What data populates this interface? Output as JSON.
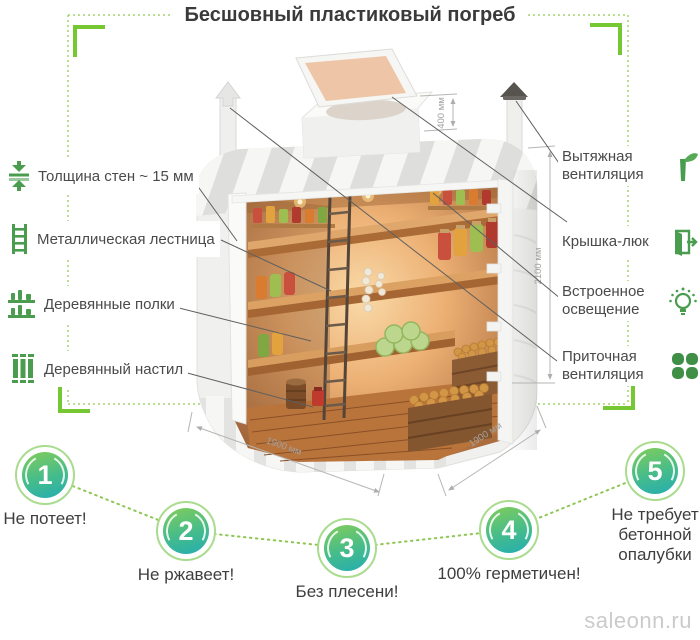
{
  "title": "Бесшовный пластиковый погреб",
  "left_labels": [
    {
      "label": "Толщина стен ~ 15 мм",
      "icon": "wall-thickness-icon"
    },
    {
      "label": "Металлическая лестница",
      "icon": "ladder-icon"
    },
    {
      "label": "Деревянные полки",
      "icon": "shelves-icon"
    },
    {
      "label": "Деревянный настил",
      "icon": "decking-icon"
    }
  ],
  "right_labels": [
    {
      "label": "Вытяжная вентиляция",
      "icon": "exhaust-vent-icon"
    },
    {
      "label": "Крышка-люк",
      "icon": "hatch-icon"
    },
    {
      "label": "Встроенное освещение",
      "icon": "lighting-icon"
    },
    {
      "label": "Приточная вентиляция",
      "icon": "supply-vent-icon"
    }
  ],
  "dimensions": {
    "hatch_neck_height": "400 мм",
    "total_height": "2100 мм",
    "width": "1900 мм",
    "depth": "1900 мм"
  },
  "benefits": [
    {
      "number": "1",
      "label": "Не потеет!"
    },
    {
      "number": "2",
      "label": "Не ржавеет!"
    },
    {
      "number": "3",
      "label": "Без плесени!"
    },
    {
      "number": "4",
      "label": "100% герметичен!"
    },
    {
      "number": "5",
      "label": "Не требует бетонной опалубки"
    }
  ],
  "watermark": "saleonn.ru",
  "colors": {
    "bracket_green": "#76c832",
    "dotted_green": "#a5d46e",
    "icon_green": "#4a9d4f",
    "circle_gradient_top": "#7ccb5e",
    "circle_gradient_bottom": "#28afad",
    "circle_ring": "#a9dc8e",
    "text_dark": "#3e3e3e",
    "dimension_gray": "#a8a8a6",
    "callout_gray": "#5f5f5f"
  }
}
